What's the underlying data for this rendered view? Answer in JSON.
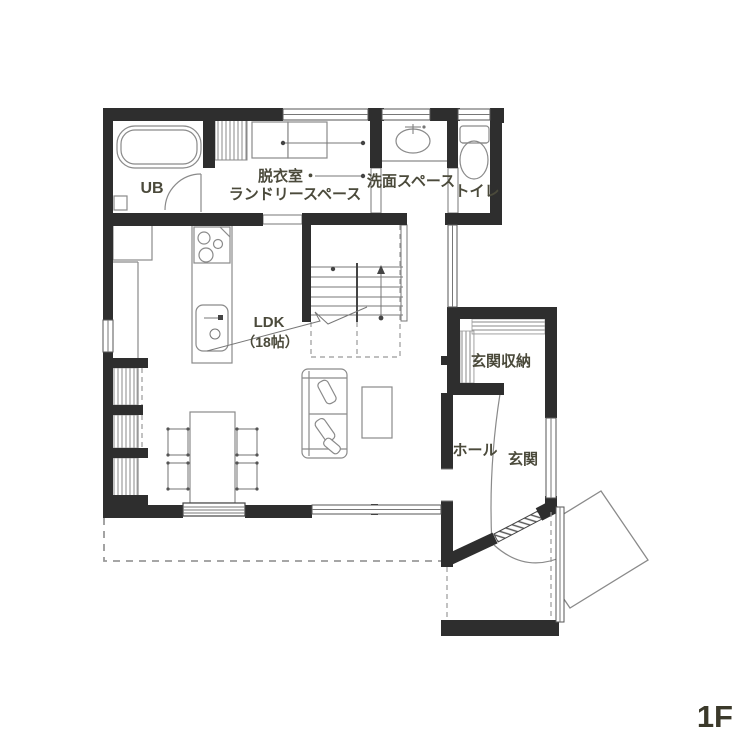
{
  "floor_label": "1F",
  "rooms": {
    "ub": "UB",
    "laundry_line1": "脱衣室・",
    "laundry_line2": "ランドリースペース",
    "washroom": "洗面スペース",
    "toilet": "トイレ",
    "ldk_line1": "LDK",
    "ldk_line2": "（18帖）",
    "entrance_storage": "玄関収納",
    "hall": "ホール",
    "entrance": "玄関"
  },
  "colors": {
    "wall": "#2e2e2e",
    "thin_line": "#8a8a8a",
    "label_text": "#4b4a3b"
  },
  "icons": [
    "bathtub-icon",
    "washing-machine-icon",
    "laundry-rod-icon",
    "washbasin-icon",
    "toilet-icon",
    "stove-icon",
    "kitchen-sink-icon",
    "refrigerator-icon",
    "dining-table-icon",
    "chair-icon",
    "sofa-icon",
    "coffee-table-icon",
    "stairs-icon",
    "entrance-door-icon",
    "shelf-hatch-icon"
  ]
}
